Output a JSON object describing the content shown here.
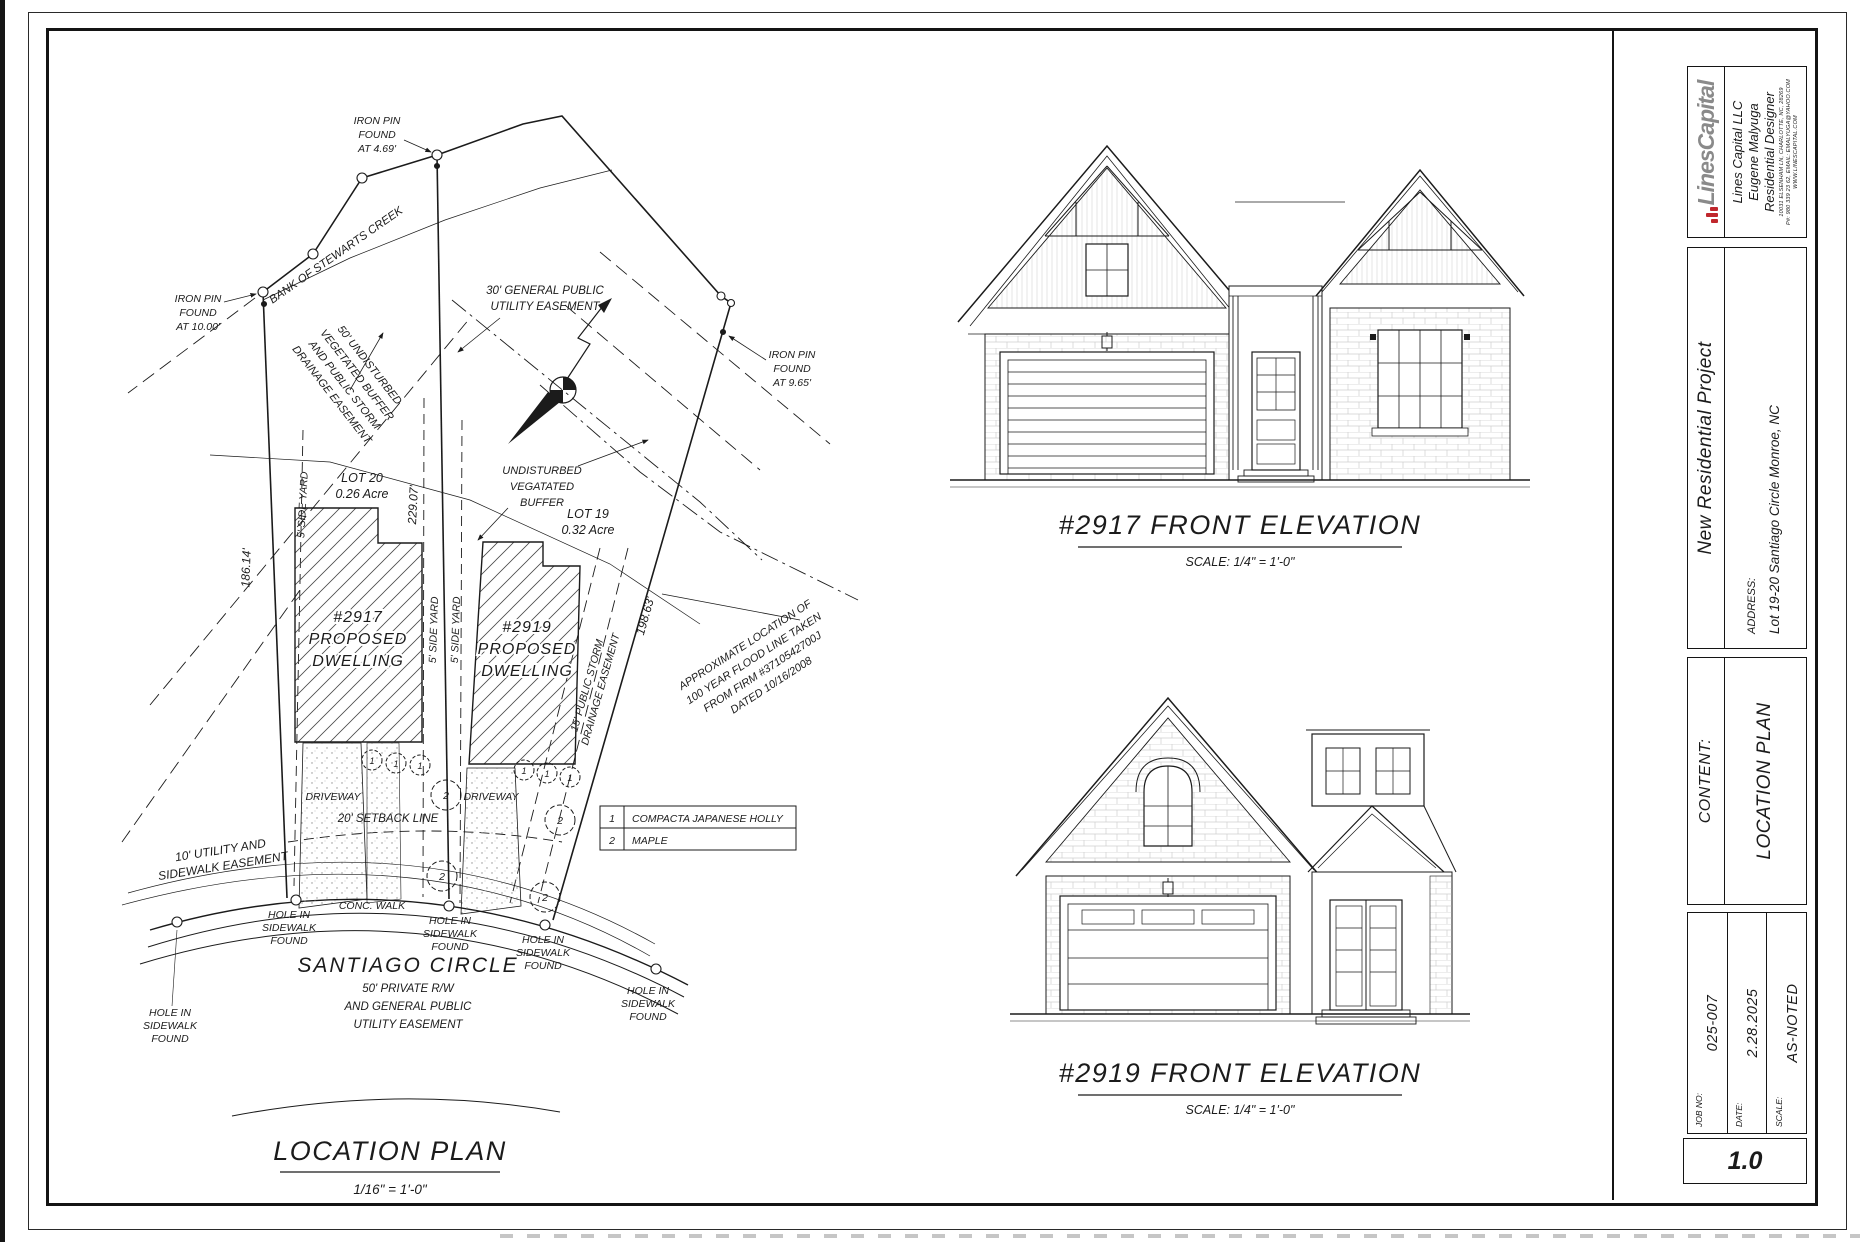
{
  "page": {
    "sheet_number": "1.0"
  },
  "brand": {
    "logo_text": "LinesCapital",
    "company_name": "Lines Capital LLC",
    "designer": "Eugene Malyuga",
    "role": "Residential Designer",
    "address": "10031 ELSENHAM LN, CHARLOTTE, NC, 28269",
    "contact": "P#: 980 339 23 62, EMAIL: EMALYUGA@YAHOO.COM",
    "website": "WWW.LINESCAPITAL.COM",
    "accent_red": "#c0272d",
    "logo_gray": "#8a8a8a"
  },
  "title_block": {
    "project_name": "New Residential Project",
    "address_label": "ADDRESS:",
    "address_value": "Lot 19-20 Santiago Circle Monroe, NC",
    "content_label": "CONTENT:",
    "content_value": "LOCATION PLAN",
    "job_label": "JOB NO:",
    "job_value": "025-007",
    "date_label": "DATE:",
    "date_value": "2.28.2025",
    "scale_label": "SCALE:",
    "scale_value": "AS-NOTED"
  },
  "plan": {
    "title": "LOCATION PLAN",
    "scale": "1/16\" = 1'-0\"",
    "road_name": "SANTIAGO CIRCLE",
    "road_sub": [
      "50' PRIVATE R/W",
      "AND GENERAL PUBLIC",
      "UTILITY EASEMENT"
    ],
    "lot20": {
      "name": "LOT 20",
      "area": "0.26 Acre"
    },
    "lot19": {
      "name": "LOT 19",
      "area": "0.32 Acre"
    },
    "dwelling_2917": [
      "#2917",
      "PROPOSED",
      "DWELLING"
    ],
    "dwelling_2919": [
      "#2919",
      "PROPOSED",
      "DWELLING"
    ],
    "dim_left": "186.14'",
    "dim_middle": "229.07'",
    "dim_right": "198.63'",
    "side_yard": "5' SIDE YARD",
    "setback": "20' SETBACK LINE",
    "driveway": "DRIVEWAY",
    "conc_walk": "CONC. WALK",
    "creek": "BANK OF STEWARTS CREEK",
    "iron_pin_10": [
      "IRON PIN",
      "FOUND",
      "AT 10.00'"
    ],
    "iron_pin_469": [
      "IRON PIN",
      "FOUND",
      "AT 4.69'"
    ],
    "iron_pin_965": [
      "IRON PIN",
      "FOUND",
      "AT 9.65'"
    ],
    "hole": [
      "HOLE IN",
      "SIDEWALK",
      "FOUND"
    ],
    "buffer_diag": [
      "50' UNDISTURBED",
      "VEGETATED BUFFER",
      "AND PUBLIC STORM",
      "DRAINAGE EASEMENT"
    ],
    "utility_30": [
      "30' GENERAL PUBLIC",
      "UTILITY EASEMENT"
    ],
    "buffer_label": [
      "UNDISTURBED",
      "VEGATATED",
      "BUFFER"
    ],
    "storm_15": [
      "15' PUBLIC STORM",
      "DRAINAGE EASEMENT"
    ],
    "utility_10": [
      "10' UTILITY AND",
      "SIDEWALK EASEMENT"
    ],
    "flood": [
      "APPROXIMATE LOCATION OF",
      "100 YEAR FLOOD LINE TAKEN",
      "FROM FIRM #3710542700J",
      "DATED 10/16/2008"
    ],
    "plant_table": [
      {
        "num": "1",
        "name": "COMPACTA JAPANESE HOLLY"
      },
      {
        "num": "2",
        "name": "MAPLE"
      }
    ],
    "shrub_num": "1",
    "tree_num": "2"
  },
  "elevations": {
    "e2917": {
      "title": "#2917 FRONT ELEVATION",
      "scale": "SCALE: 1/4\" = 1'-0\""
    },
    "e2919": {
      "title": "#2919 FRONT ELEVATION",
      "scale": "SCALE: 1/4\" = 1'-0\""
    }
  }
}
